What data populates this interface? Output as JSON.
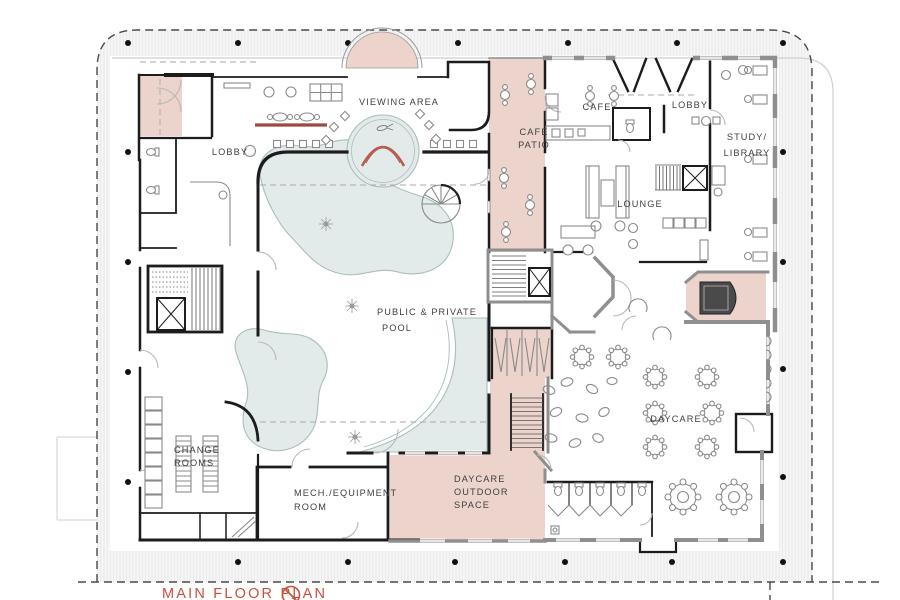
{
  "rooms": {
    "lobby_left": {
      "label": "LOBBY"
    },
    "viewing_area": {
      "label": "VIEWING AREA"
    },
    "cafe_patio": {
      "lines": [
        "CAFE",
        "PATIO"
      ]
    },
    "cafe": {
      "label": "CAFE"
    },
    "lobby_right": {
      "label": "LOBBY"
    },
    "study_library": {
      "lines": [
        "STUDY/",
        "LIBRARY"
      ]
    },
    "lounge": {
      "label": "LOUNGE"
    },
    "pool": {
      "lines": [
        "PUBLIC & PRIVATE",
        "POOL"
      ]
    },
    "change_rooms": {
      "lines": [
        "CHANGE",
        "ROOMS"
      ]
    },
    "mech_room": {
      "lines": [
        "MECH./EQUIPMENT",
        "ROOM"
      ]
    },
    "daycare_outdoor": {
      "lines": [
        "DAYCARE",
        "OUTDOOR",
        "SPACE"
      ]
    },
    "daycare": {
      "label": "DAYCARE"
    }
  },
  "title": {
    "text": "MAIN FLOOR PLAN"
  },
  "icons": {
    "north_arrow": "compass-north-arrow"
  },
  "colors": {
    "pink": "#ecd3cb",
    "pool": "#e2ebe9",
    "pool-edge": "#a9bebc",
    "accent-red": "#b85c4e",
    "counter-red": "#9d4a42",
    "title-red": "#c8503c",
    "wall-black": "#1c1c1c",
    "wall-gray": "#8f8f8f",
    "label-gray": "#3f3f3f"
  }
}
